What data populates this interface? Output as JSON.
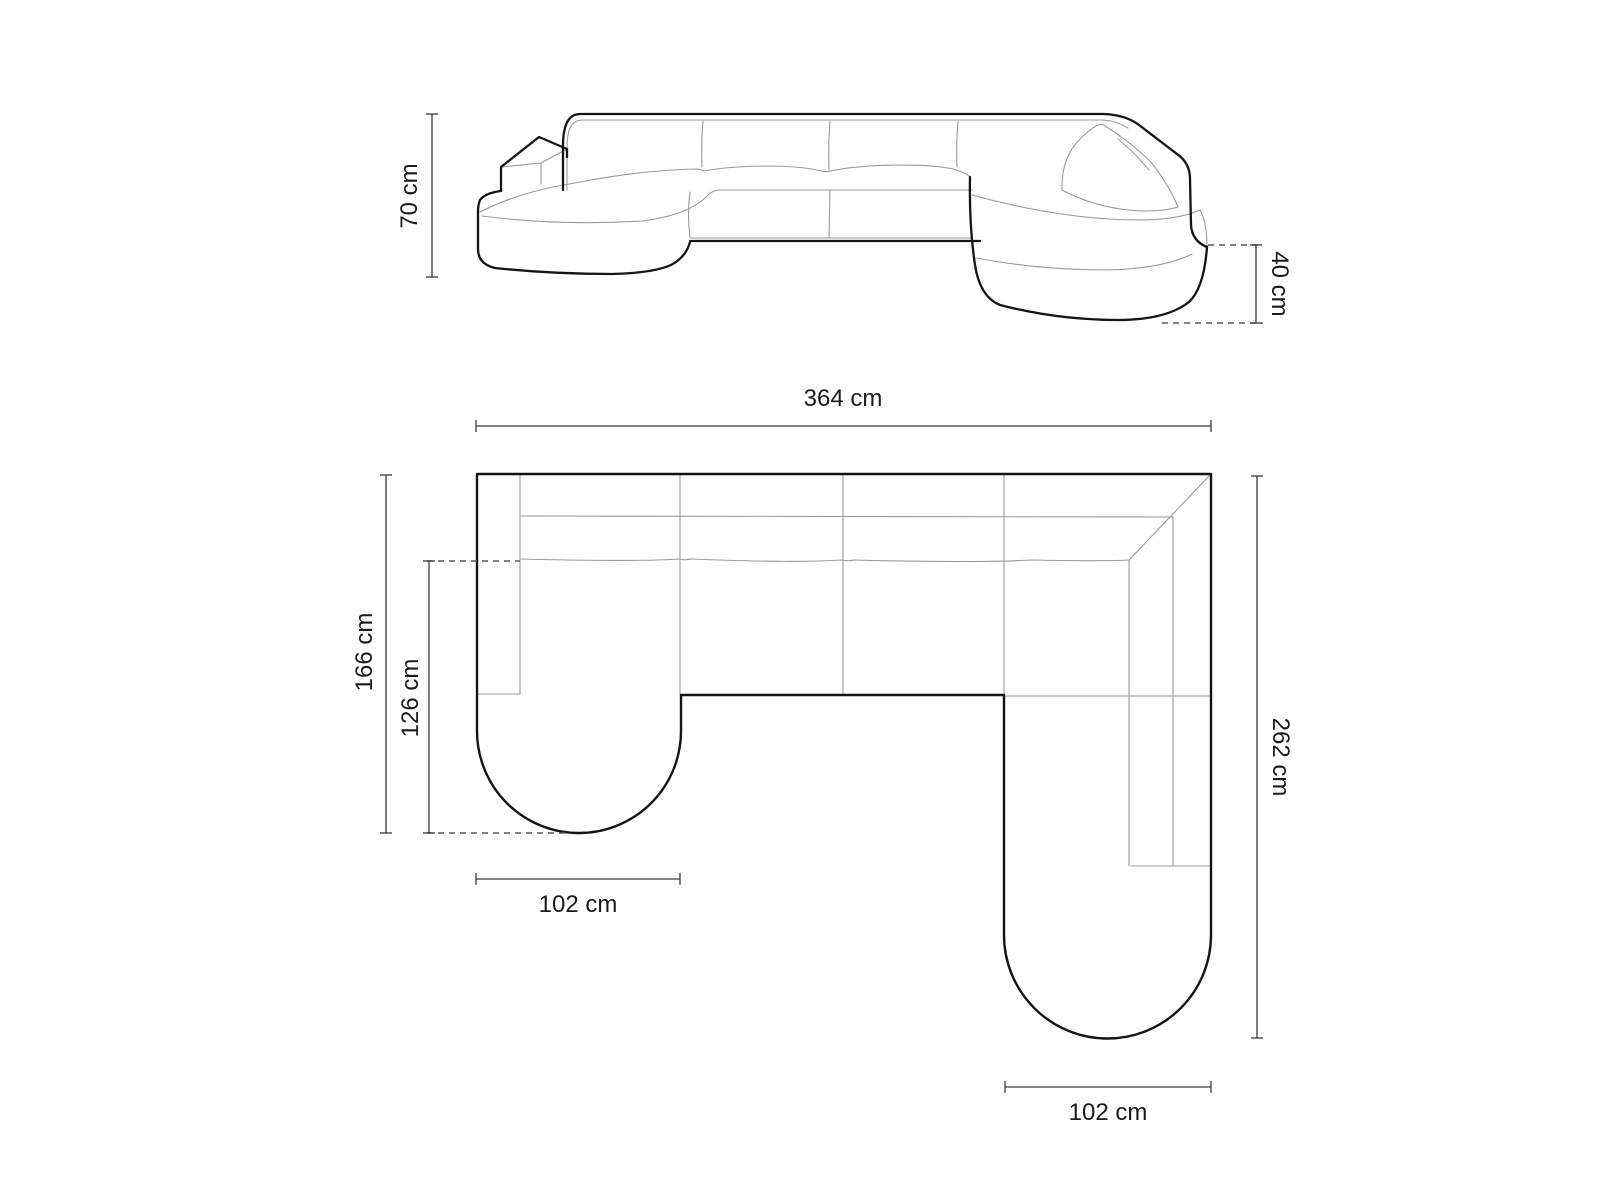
{
  "diagram": {
    "subject": "u-shaped-panoramic-sofa-dimension-drawing",
    "views": {
      "elevation": "front-perspective-view",
      "plan": "top-plan-view"
    }
  },
  "dimensions": {
    "height": "70 cm",
    "chaise_height": "40 cm",
    "total_width": "364 cm",
    "left_depth": "166 cm",
    "left_inner_depth": "126 cm",
    "right_depth": "262 cm",
    "left_chaise_width": "102 cm",
    "right_chaise_width": "102 cm"
  },
  "colors": {
    "background": "#ffffff",
    "outline": "#151515",
    "detail_line": "#999999",
    "dimension_line": "#3a3a3a",
    "dashed_line": "#5a5a5a",
    "text": "#1a1a1a"
  }
}
